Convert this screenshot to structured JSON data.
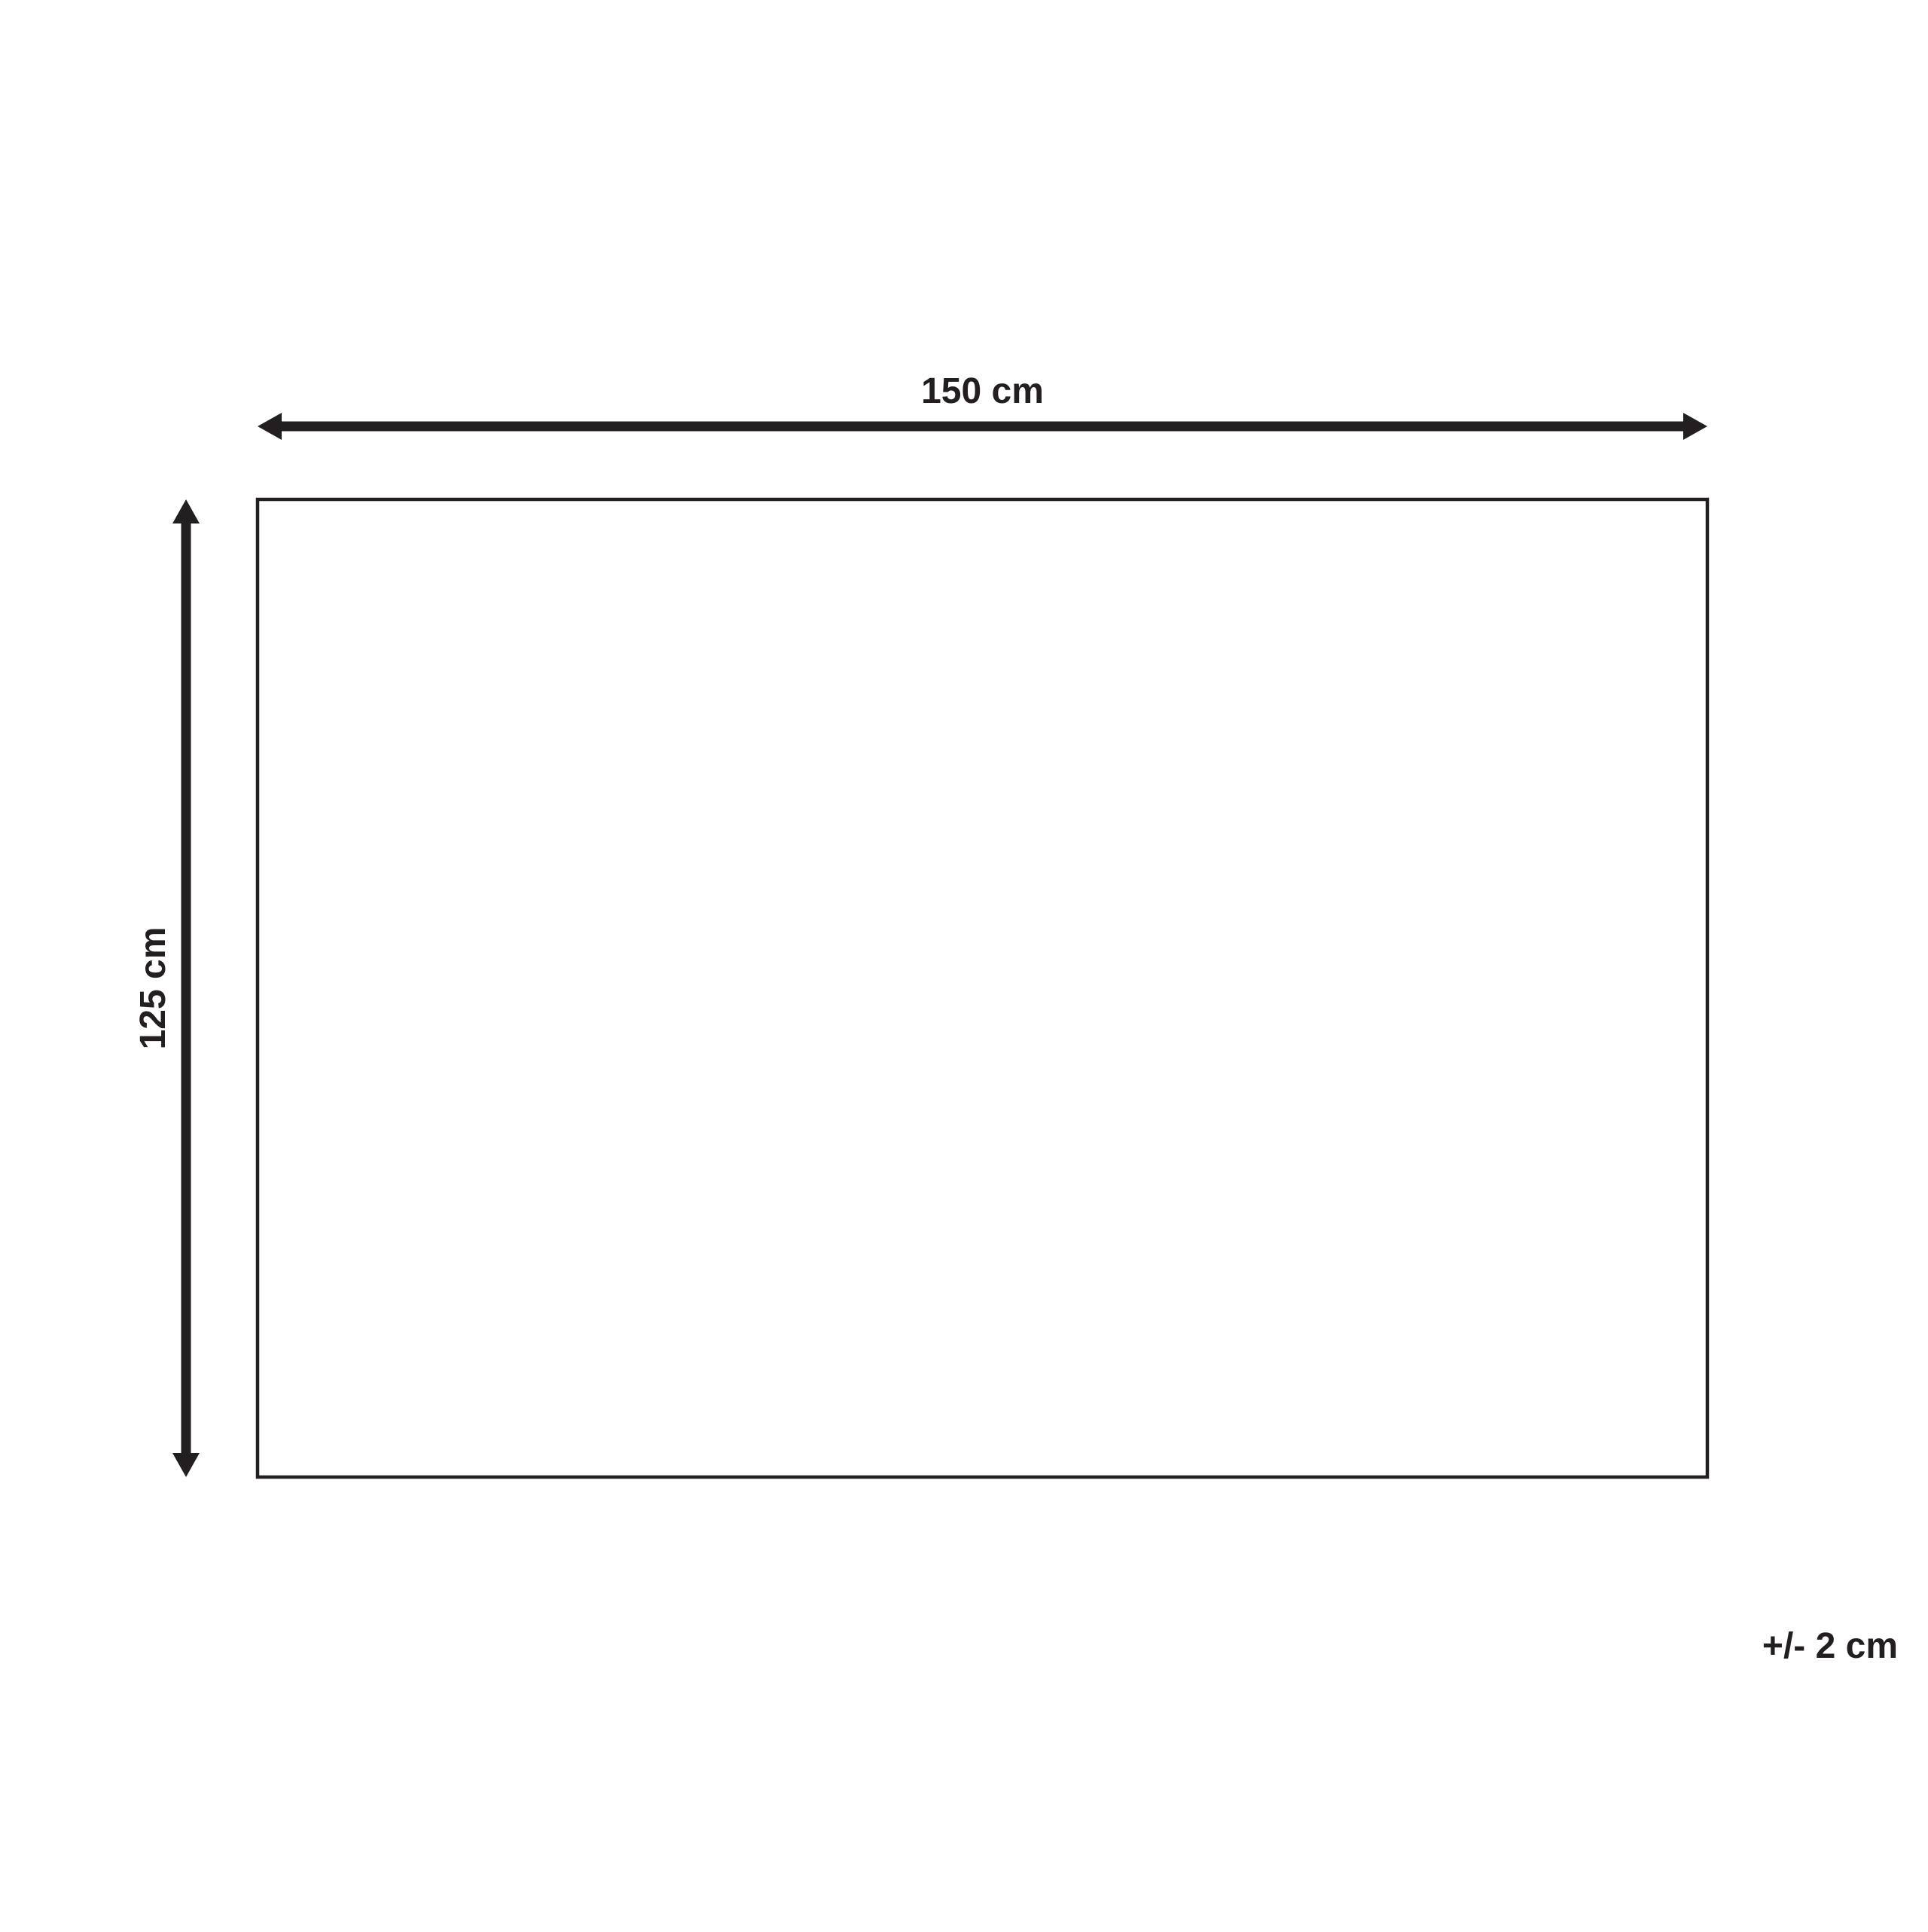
{
  "diagram": {
    "title": "product-dimension-diagram",
    "width_label": "150 cm",
    "height_label": "125 cm",
    "tolerance_label": "+/- 2 cm"
  },
  "colors": {
    "line": "#231f20",
    "background": "#ffffff"
  }
}
